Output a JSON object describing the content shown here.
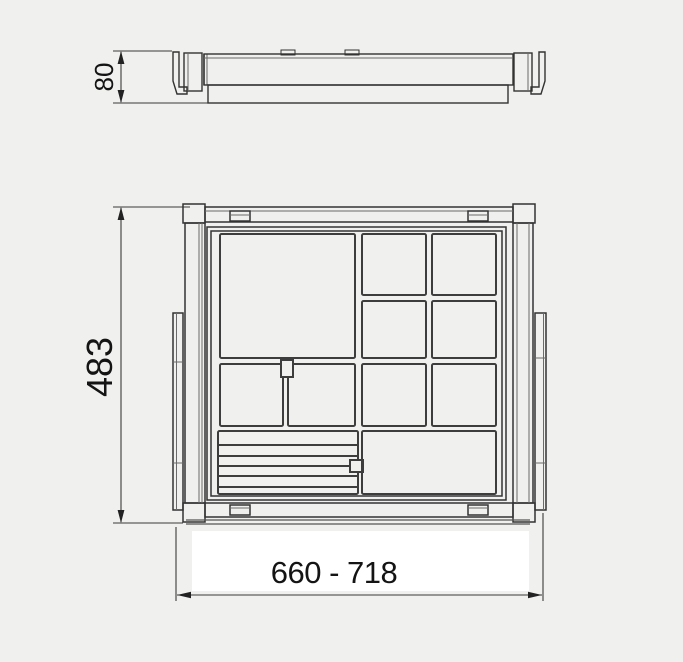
{
  "colors": {
    "background": "#f0f0ef",
    "line": "#2b2b2b",
    "text": "#141414",
    "label_backdrop": "#ffffff"
  },
  "side_view": {
    "dimension_height": "80"
  },
  "plan_view": {
    "dimension_depth": "483",
    "dimension_width_range": "660 - 718"
  }
}
